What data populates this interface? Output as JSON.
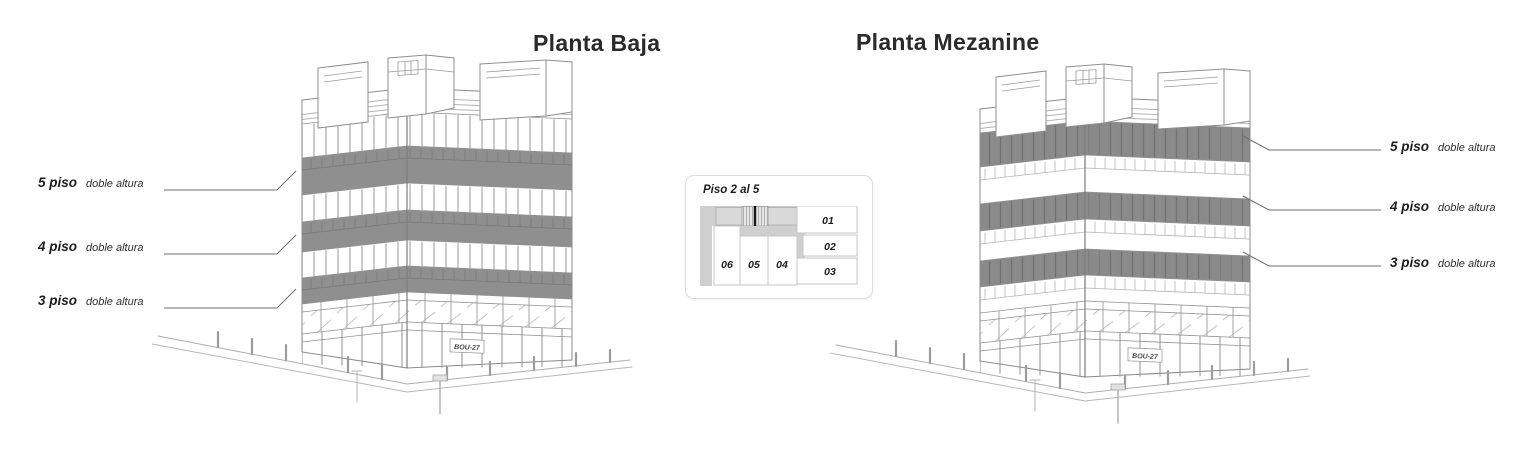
{
  "left_panel": {
    "title": "Planta Baja",
    "floor_labels": [
      {
        "floor": "5 piso",
        "note": "doble altura"
      },
      {
        "floor": "4 piso",
        "note": "doble altura"
      },
      {
        "floor": "3 piso",
        "note": "doble altura"
      }
    ]
  },
  "right_panel": {
    "title": "Planta Mezanine",
    "floor_labels": [
      {
        "floor": "5 piso",
        "note": "doble altura"
      },
      {
        "floor": "4 piso",
        "note": "doble altura"
      },
      {
        "floor": "3 piso",
        "note": "doble altura"
      }
    ]
  },
  "plan_card": {
    "title": "Piso 2 al 5",
    "units": {
      "u01": "01",
      "u02": "02",
      "u03": "03",
      "u04": "04",
      "u05": "05",
      "u06": "06"
    }
  },
  "building": {
    "storefront_sign": "BOU-27"
  },
  "colors": {
    "band_gray": "#8f8f8f",
    "louver_gray": "#8a8a8a",
    "plan_gray": "#cfcfcf",
    "line_gray": "#9a9a9a",
    "text_dark": "#2b2b2b"
  }
}
